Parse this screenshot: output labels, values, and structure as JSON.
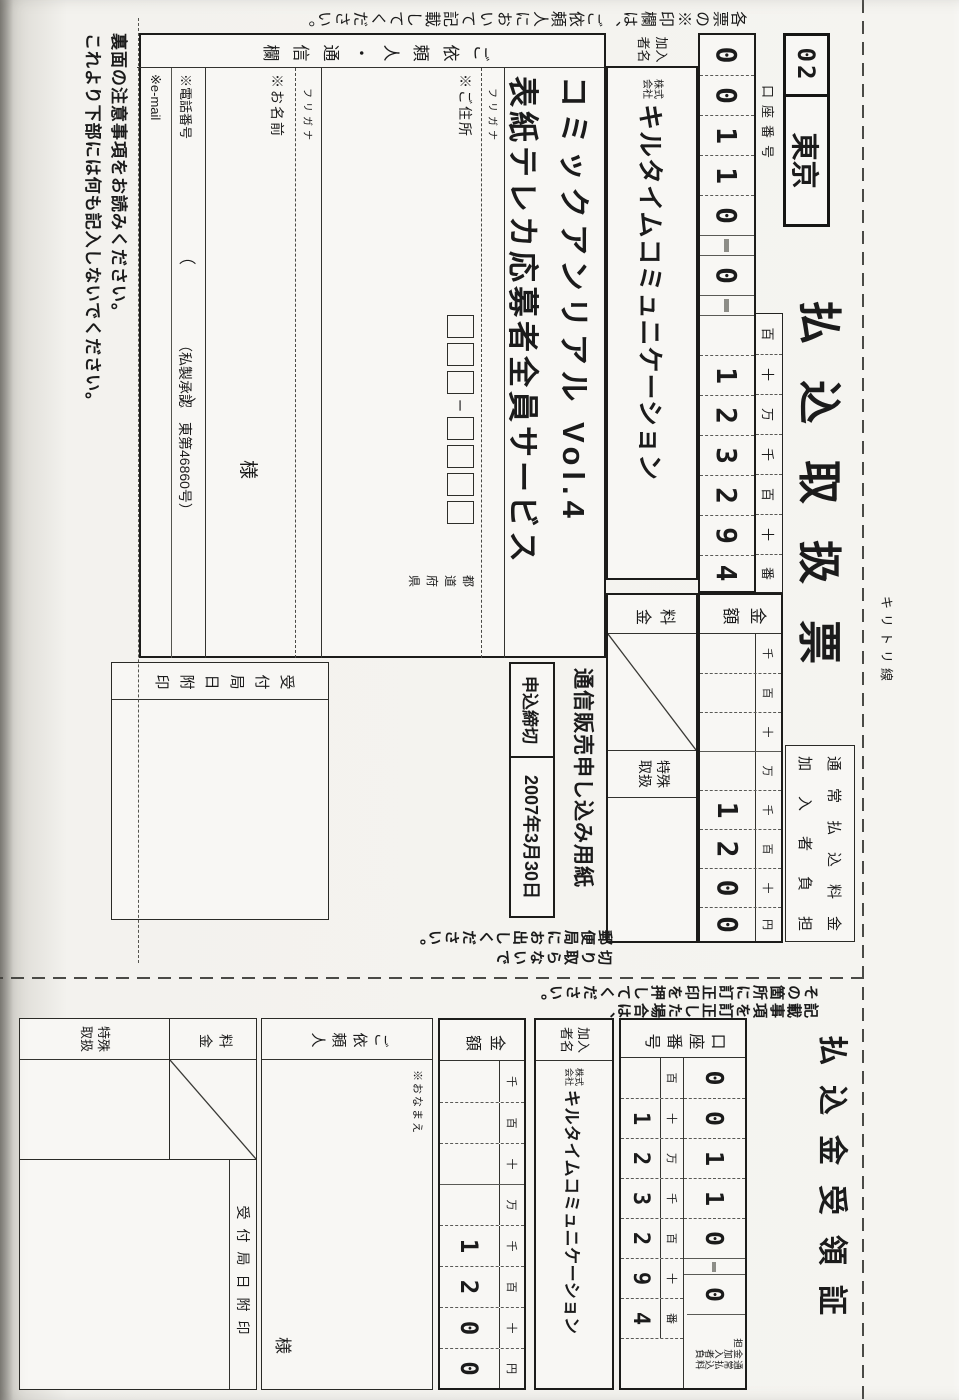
{
  "page": {
    "cut_line_label": "キリトリ線",
    "colors": {
      "ink": "#1b1b1b",
      "paper": "#f3f2ee"
    }
  },
  "slip": {
    "edge_note": "各票の※印欄は、ご依頼人において記載してください。",
    "title": "払込取扱票",
    "bank_code": "02",
    "bank_name": "東京",
    "account": {
      "label": "口座番号",
      "prefix": [
        "0",
        "0",
        "1",
        "1",
        "0"
      ],
      "middle": "0",
      "headers": [
        "百",
        "十",
        "万",
        "千",
        "百",
        "十",
        "番"
      ],
      "digits": [
        "",
        "1",
        "2",
        "3",
        "2",
        "9",
        "4"
      ]
    },
    "fee_note": {
      "line1": "通常払込料金",
      "line2": "加入者負担"
    },
    "amount": {
      "label": "金額",
      "headers": [
        "千",
        "百",
        "十",
        "万",
        "千",
        "百",
        "十",
        "円"
      ],
      "digits": [
        "",
        "",
        "",
        "",
        "1",
        "2",
        "0",
        "0"
      ]
    },
    "payee": {
      "label": "加入者名",
      "prefix": "株式会社",
      "name": "キルタイムコミュニケーション"
    },
    "fee_label": "料金",
    "special_label": "特殊取扱",
    "product": {
      "line1": "コミックアンリアル Vol.4",
      "line2": "表紙テレカ応募者全員サービス"
    },
    "order": {
      "form_label": "通信販売申し込み用紙",
      "deadline_label": "申込締切",
      "deadline_value": "2007年3月30日"
    },
    "client": {
      "label": "ご依頼人・通信欄",
      "furigana": "フリガナ",
      "address_label": "※ご住所",
      "postal_sep": "ー",
      "prefecture": "都道府県",
      "name_label": "※お名前",
      "honorific": "様",
      "phone_label": "※電話番号",
      "paren_open": "（",
      "paren_close": "）",
      "email_label": "※e-mail"
    },
    "stamp_label": "受付局日附印",
    "cut_note": {
      "line1": "切り取らないで",
      "line2": "郵便局にお出しください。"
    },
    "approval": "（私製承認　東第46860号）",
    "bottom_note1": "裏面の注意事項をお読みください。",
    "bottom_note2": "これより下部には何も記入しないでください。"
  },
  "receipt": {
    "title": "払込金受領証",
    "edge_note1": "記載事項を訂正した場合は、",
    "edge_note2": "その箇所に訂正印を押してください。",
    "account": {
      "label": "口座番号",
      "prefix": [
        "0",
        "0",
        "1",
        "1",
        "0"
      ],
      "middle": "0",
      "headers": [
        "百",
        "十",
        "万",
        "千",
        "百",
        "十",
        "番"
      ],
      "digits": [
        "",
        "1",
        "2",
        "3",
        "2",
        "9",
        "4"
      ]
    },
    "fee_note": "通常払込料金加入者負担",
    "payee": {
      "label": "加入者名",
      "prefix": "株式会社",
      "name": "キルタイムコミュニケーション"
    },
    "amount": {
      "label": "金額",
      "headers": [
        "千",
        "百",
        "十",
        "万",
        "千",
        "百",
        "十",
        "円"
      ],
      "digits": [
        "",
        "",
        "",
        "",
        "1",
        "2",
        "0",
        "0"
      ]
    },
    "client": {
      "label": "ご依頼人",
      "name_label": "※おなまえ",
      "honorific": "様"
    },
    "fee_label": "料金",
    "special_label": "特殊取扱",
    "stamp_label": "受付局日附印"
  }
}
